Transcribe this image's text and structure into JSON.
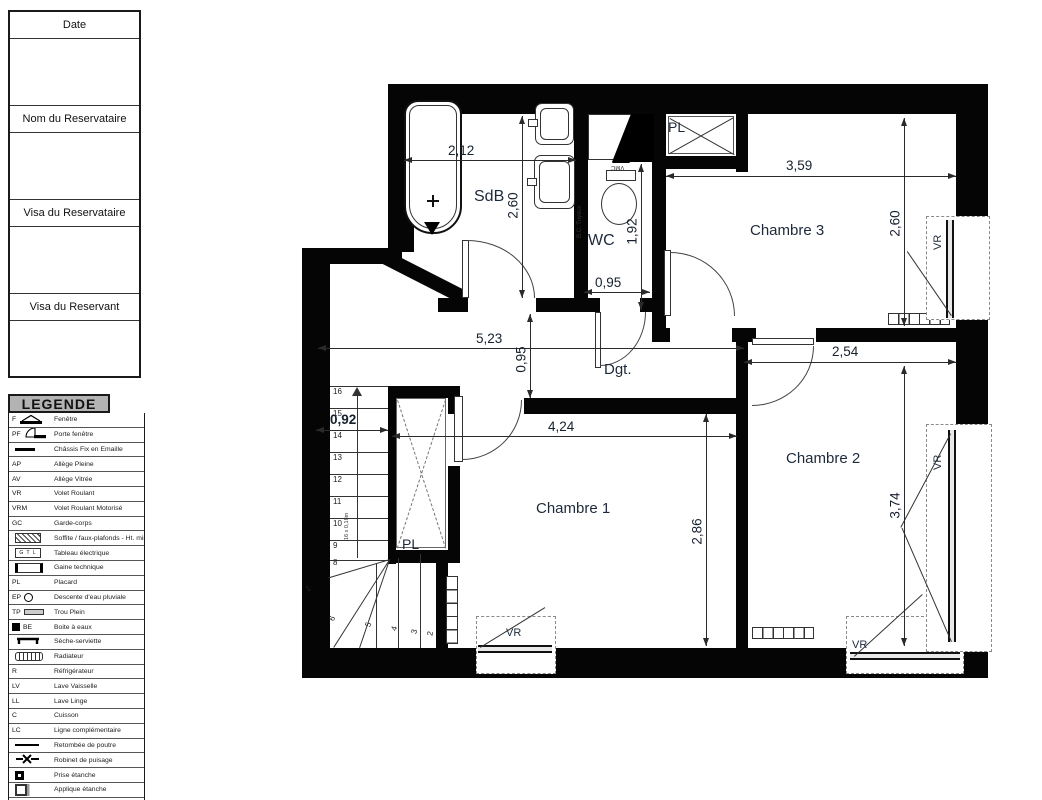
{
  "title_block": {
    "date_label": "Date",
    "nom_label": "Nom du Reservataire",
    "visa_reservataire_label": "Visa du Reservataire",
    "visa_reservant_label": "Visa du Reservant"
  },
  "legend": {
    "title": "LEGENDE",
    "items": [
      {
        "abbr": "F",
        "desc": "Fenêtre"
      },
      {
        "abbr": "PF",
        "desc": "Porte fenêtre"
      },
      {
        "abbr": "",
        "desc": "Châssis Fix en Emaille"
      },
      {
        "abbr": "AP",
        "desc": "Allège Pleine"
      },
      {
        "abbr": "AV",
        "desc": "Allège Vitrée"
      },
      {
        "abbr": "VR",
        "desc": "Volet Roulant"
      },
      {
        "abbr": "VRM",
        "desc": "Volet Roulant Motorisé"
      },
      {
        "abbr": "GC",
        "desc": "Garde-corps"
      },
      {
        "abbr": "",
        "desc": "Soffite / faux-plafonds - Ht. min."
      },
      {
        "abbr": "",
        "desc": "Tableau électrique",
        "icon_label": "G T L"
      },
      {
        "abbr": "",
        "desc": "Gaine technique"
      },
      {
        "abbr": "PL",
        "desc": "Placard"
      },
      {
        "abbr": "EP",
        "desc": "Descente d'eau pluviale"
      },
      {
        "abbr": "TP",
        "desc": "Trou Plein"
      },
      {
        "abbr": "BE",
        "desc": "Boite à eaux"
      },
      {
        "abbr": "",
        "desc": "Sèche-serviette"
      },
      {
        "abbr": "",
        "desc": "Radiateur"
      },
      {
        "abbr": "R",
        "desc": "Réfrigérateur"
      },
      {
        "abbr": "LV",
        "desc": "Lave Vaisselle"
      },
      {
        "abbr": "LL",
        "desc": "Lave Linge"
      },
      {
        "abbr": "C",
        "desc": "Cuisson"
      },
      {
        "abbr": "LC",
        "desc": "Ligne complémentaire"
      },
      {
        "abbr": "",
        "desc": "Retombée de poutre"
      },
      {
        "abbr": "",
        "desc": "Robinet de puisage"
      },
      {
        "abbr": "",
        "desc": "Prise étanche"
      },
      {
        "abbr": "",
        "desc": "Applique étanche"
      },
      {
        "abbr": "HSFP",
        "desc": "Hauteur Sous Faux-Plafond"
      },
      {
        "abbr": "HSP",
        "desc": "Hauteur Sous Poutre"
      }
    ]
  },
  "plan": {
    "rooms": {
      "sdb": "SdB",
      "wc": "WC",
      "pl_top": "PL",
      "chambre3": "Chambre 3",
      "dgt": "Dgt.",
      "pl_stairs": "PL",
      "chambre1": "Chambre 1",
      "chambre2": "Chambre 2"
    },
    "dims": {
      "sdb_w": "2,12",
      "sdb_h": "2,60",
      "wc_h": "1,92",
      "wc_w": "0,95",
      "ch3_w": "3,59",
      "ch3_h": "2,60",
      "hall_w": "5,23",
      "hall_h": "0,95",
      "ch2_w": "2,54",
      "stair_w": "0,92",
      "ch1_w": "4,24",
      "ch1_h": "2,86",
      "ch2_h": "3,74"
    },
    "labels": {
      "vmc": "VMC",
      "bc_tuyaux": "B.C. Tuyaux",
      "vr": "VR",
      "stair_note": "16 x 0,18m"
    },
    "stairs": {
      "flight": [
        "16",
        "15",
        "14",
        "13",
        "12",
        "11",
        "10",
        "9",
        "8"
      ],
      "winders": [
        "1",
        "6",
        "5",
        "4",
        "3",
        "2"
      ]
    }
  }
}
